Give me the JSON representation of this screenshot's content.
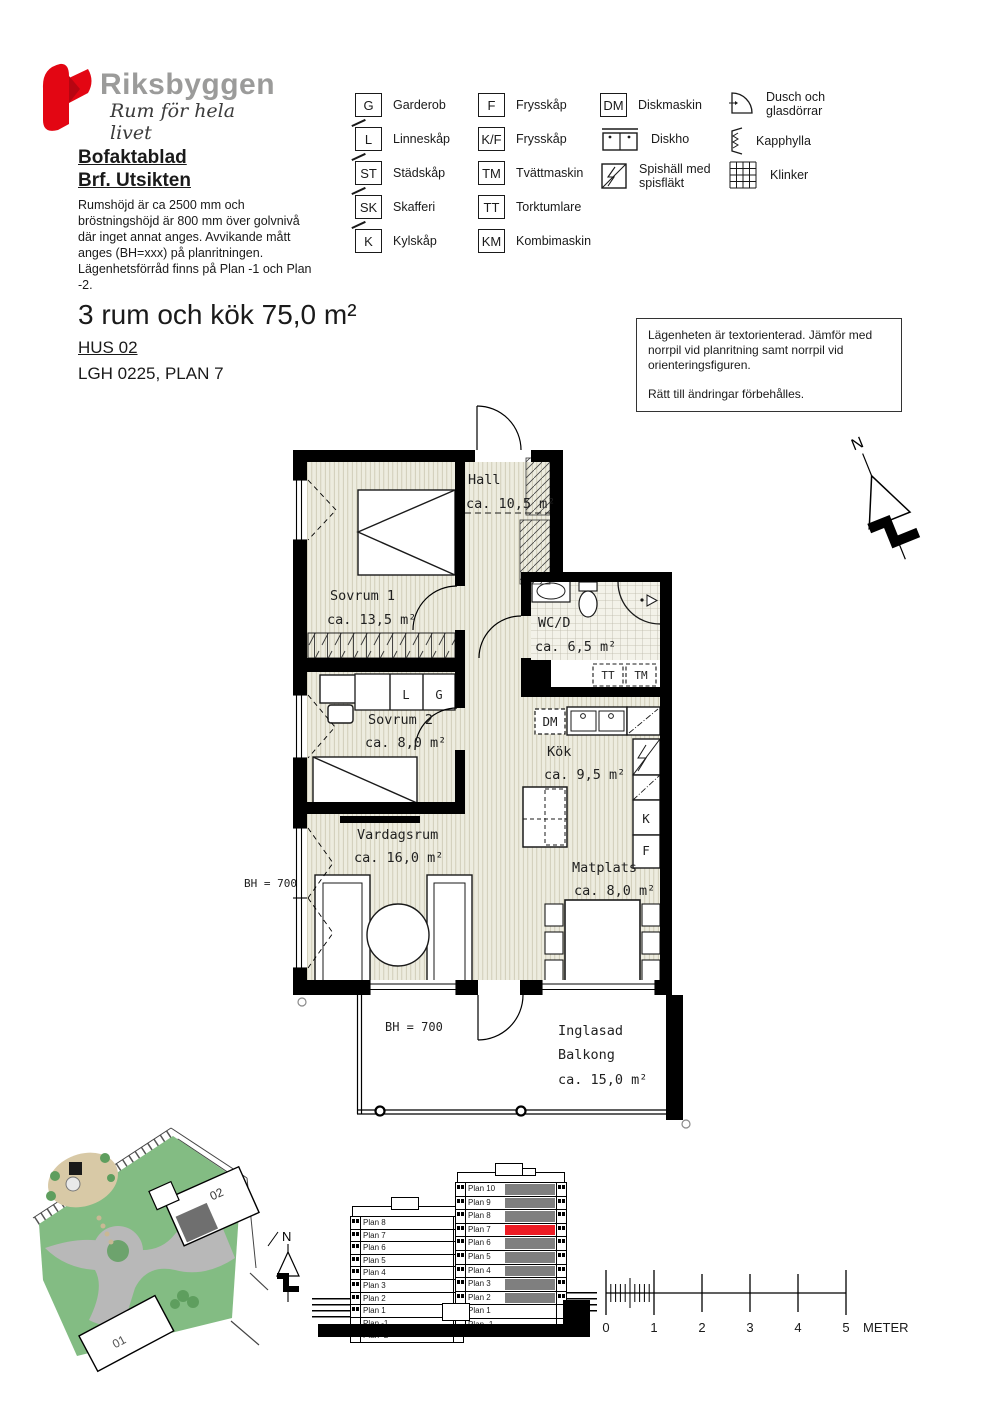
{
  "brand": {
    "name": "Riksbyggen",
    "tagline": "Rum för hela livet",
    "red": "#e30613",
    "gray": "#9b9b9a"
  },
  "doc": {
    "title": "Bofaktablad",
    "subtitle": "Brf. Utsikten",
    "description_lines": [
      "Rumshöjd är ca 2500 mm och",
      "bröstningshöjd är 800 mm över golvnivå",
      "där inget annat anges. Avvikande mått",
      "anges (BH=xxx) på planritningen.",
      "Lägenhetsförråd finns på Plan -1 och Plan -2."
    ]
  },
  "legend": {
    "col1": [
      {
        "abbr": "G",
        "label": "Garderob"
      },
      {
        "abbr": "L",
        "label": "Linneskåp"
      },
      {
        "abbr": "ST",
        "label": "Städskåp"
      },
      {
        "abbr": "SK",
        "label": "Skafferi"
      },
      {
        "abbr": "K",
        "label": "Kylskåp"
      }
    ],
    "col2": [
      {
        "abbr": "F",
        "label": "Frysskåp"
      },
      {
        "abbr": "K/F",
        "label": "Frysskåp"
      },
      {
        "abbr": "TM",
        "label": "Tvättmaskin"
      },
      {
        "abbr": "TT",
        "label": "Torktumlare"
      },
      {
        "abbr": "KM",
        "label": "Kombimaskin"
      }
    ],
    "col3": [
      {
        "abbr": "DM",
        "label": "Diskmaskin"
      },
      {
        "label": "Diskho"
      },
      {
        "label": "Spishäll med spisfläkt"
      }
    ],
    "col4": [
      {
        "label": "Dusch och glasdörrar"
      },
      {
        "label": "Kapphylla"
      },
      {
        "label": "Klinker"
      }
    ]
  },
  "apartment": {
    "title": "3 rum och kök  75,0 m²",
    "hus": "HUS 02",
    "lgh": "LGH 0225, PLAN 7"
  },
  "notice": {
    "para1": "Lägenheten är textorienterad. Jämför med norrpil vid planritning samt norrpil vid orienteringsfiguren.",
    "para2": "Rätt till ändringar förbehålles."
  },
  "floorplan": {
    "north_label": "N",
    "rooms": {
      "hall": {
        "name": "Hall",
        "area": "ca. 10,5 m²"
      },
      "sovrum1": {
        "name": "Sovrum 1",
        "area": "ca. 13,5 m²"
      },
      "wcd": {
        "name": "WC/D",
        "area": "ca. 6,5 m²"
      },
      "sovrum2": {
        "name": "Sovrum 2",
        "area": "ca. 8,0 m²"
      },
      "kok": {
        "name": "Kök",
        "area": "ca. 9,5 m²"
      },
      "vardagsrum": {
        "name": "Vardagsrum",
        "area": "ca. 16,0 m²"
      },
      "matplats": {
        "name": "Matplats",
        "area": "ca. 8,0 m²"
      },
      "balkong": {
        "name1": "Inglasad",
        "name2": "Balkong",
        "area": "ca. 15,0 m²"
      }
    },
    "labels": {
      "bh_left": "BH = 700",
      "bh_balcony": "BH = 700",
      "l": "L",
      "g": "G",
      "k": "K",
      "f": "F",
      "dm": "DM",
      "tt": "TT",
      "tm": "TM"
    }
  },
  "siteplan": {
    "building1": "01",
    "building2": "02",
    "north_label": "N"
  },
  "elevations": {
    "left_building": [
      "Plan 8",
      "Plan 7",
      "Plan 6",
      "Plan 5",
      "Plan 4",
      "Plan 3",
      "Plan 2",
      "Plan 1",
      "Plan -1",
      "Plan -2"
    ],
    "right_building": [
      {
        "label": "Plan 10",
        "fill": "gray"
      },
      {
        "label": "Plan 9",
        "fill": "gray"
      },
      {
        "label": "Plan 8",
        "fill": "gray"
      },
      {
        "label": "Plan 7",
        "fill": "red"
      },
      {
        "label": "Plan 6",
        "fill": "gray"
      },
      {
        "label": "Plan 5",
        "fill": "gray"
      },
      {
        "label": "Plan 4",
        "fill": "gray"
      },
      {
        "label": "Plan 3",
        "fill": "gray"
      },
      {
        "label": "Plan 2",
        "fill": "gray"
      },
      {
        "label": "Plan 1",
        "fill": "white"
      },
      {
        "label": "Plan -1",
        "fill": "white"
      }
    ],
    "highlight_color": "#ed1c24",
    "shade_color": "#7f7f7f"
  },
  "scalebar": {
    "ticks": [
      "0",
      "1",
      "2",
      "3",
      "4",
      "5"
    ],
    "unit": "METER"
  }
}
